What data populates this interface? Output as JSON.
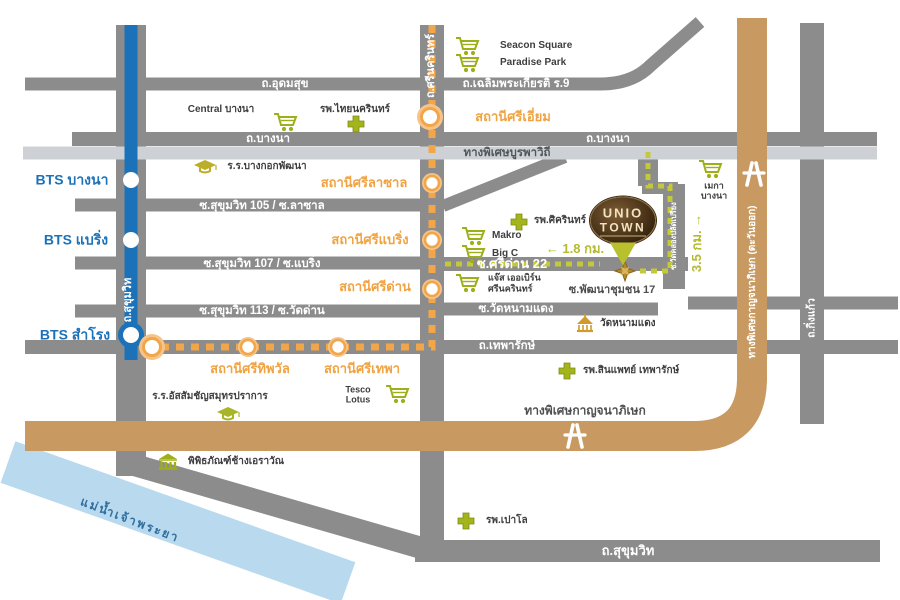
{
  "project": {
    "line1": "UNIO",
    "line2": "TOWN"
  },
  "transit": {
    "bts_stations": [
      {
        "label": "BTS บางนา"
      },
      {
        "label": "BTS แบริ่ง"
      },
      {
        "label": "BTS สำโรง"
      }
    ],
    "yellow_line_stations": [
      {
        "label": "สถานีศรีเอี่ยม"
      },
      {
        "label": "สถานีศรีลาซาล"
      },
      {
        "label": "สถานีศรีแบริ่ง"
      },
      {
        "label": "สถานีศรีด่าน"
      },
      {
        "label": "สถานีศรีทิพวัล"
      },
      {
        "label": "สถานีศรีเทพา"
      }
    ]
  },
  "roads": {
    "udomsuk": "ถ.อุดมสุข",
    "chalermprakiat_r9": "ถ.เฉลิมพระเกียรติ ร.9",
    "bangna_west": "ถ.บางนา",
    "bangna_east": "ถ.บางนา",
    "burapha_expressway": "ทางพิเศษบูรพาวิถี",
    "sukhumvit105": "ซ.สุขุมวิท 105 / ซ.ลาซาล",
    "sukhumvit107": "ซ.สุขุมวิท 107 / ซ.แบริ่ง",
    "sukhumvit113": "ซ.สุขุมวิท 113 / ซ.วัดด่าน",
    "sridan22": "ซ.ศรีด่าน 22",
    "watnamdaeng": "ซ.วัดหนามแดง",
    "theparak": "ถ.เทพารักษ์",
    "pattanachumchon17": "ซ.พัฒนาชุมชน 17",
    "sukhumvit_south": "ถ.สุขุมวิท",
    "sukhumvit_vertical": "ถ.สุขุมวิท",
    "srinakarin": "ถ.ศรีนครินทร์",
    "kanchanaphisek_vertical": "ทางพิเศษกาญจนาภิเษก (ตะวันออก)",
    "kanchanaphisek": "ทางพิเศษกาญจนาภิเษก",
    "kingkaew": "ถ.กิ่งแก้ว",
    "watkhlongpladpriang": "ซ.วัดคลองปลัดเปรียง"
  },
  "places": {
    "seacon": "Seacon Square",
    "paradise": "Paradise Park",
    "central": "Central บางนา",
    "thainakarin": "รพ.ไทยนครินทร์",
    "bangkokpatana": "ร.ร.บางกอกพัฒนา",
    "sikarin": "รพ.ศิครินทร์",
    "makro": "Makro",
    "bigc": "Big C",
    "jas_line1": "แจ๊ส เออเบิร์น",
    "jas_line2": "ศรีนครินทร์",
    "watnamdaeng_temple": "วัดหนามแดง",
    "tesco_line1": "Tesco",
    "tesco_line2": "Lotus",
    "assumption": "ร.ร.อัสสัมชัญสมุทรปราการ",
    "sinphaet": "รพ.สินแพทย์ เทพารักษ์",
    "erawan_museum": "พิพิธภัณฑ์ช้างเอราวัณ",
    "paolo": "รพ.เปาโล",
    "mega_line1": "เมกา",
    "mega_line2": "บางนา"
  },
  "distances": {
    "to_sridan_station": "← 1.8 กม.",
    "to_bangna_road": "3.5 กม. →"
  },
  "river": "แม่น้ำเจ้าพระยา",
  "colors": {
    "road_gray": "#8C8C8C",
    "expressway_light": "#CDD1D5",
    "bts_blue": "#1C72B8",
    "yellow_line_orange": "#F2A649",
    "highway_tan": "#C89A62",
    "poi_green": "#9FAF1A",
    "route_dash_yellow": "#C3C93A",
    "river_blue": "#B8D9EE",
    "logo_gold": "#F2E3C0"
  }
}
